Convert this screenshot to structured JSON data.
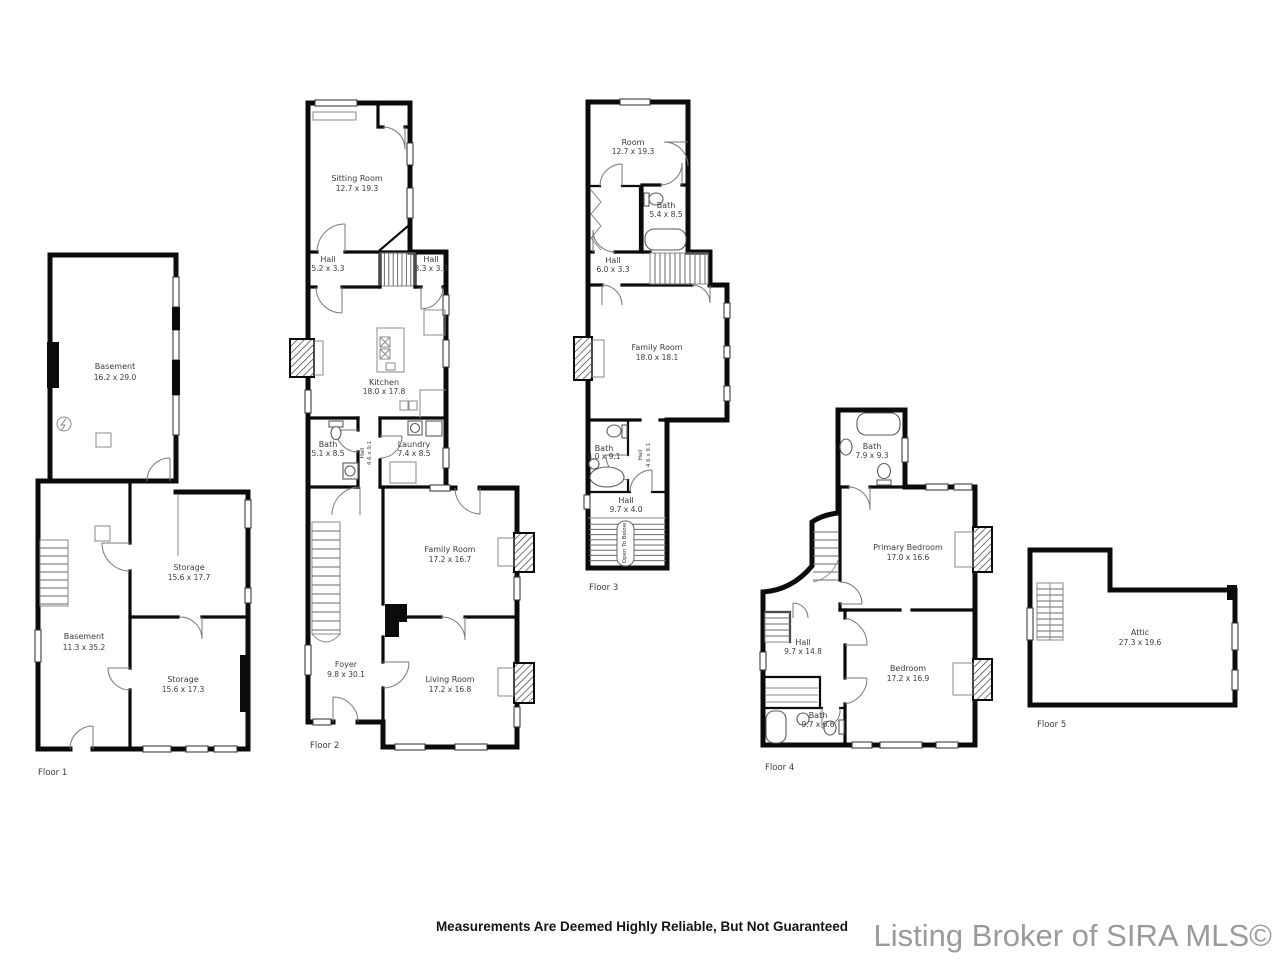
{
  "footer": {
    "disclaimer": "Measurements Are Deemed Highly Reliable, But Not Guaranteed",
    "branding": "Listing Broker of SIRA MLS©"
  },
  "colors": {
    "wall": "#0b0b0b",
    "label": "#3b3b3b",
    "branding": "#9a9a9a"
  },
  "floors": [
    {
      "label": "Floor 1",
      "rooms": [
        {
          "name": "Basement",
          "dims": "16.2 x 29.0"
        },
        {
          "name": "Storage",
          "dims": "15.6 x 17.7"
        },
        {
          "name": "Basement",
          "dims": "11.3 x 35.2"
        },
        {
          "name": "Storage",
          "dims": "15.6 x 17.3"
        }
      ]
    },
    {
      "label": "Floor 2",
      "rooms": [
        {
          "name": "Sitting Room",
          "dims": "12.7 x 19.3"
        },
        {
          "name": "Hall",
          "dims": "5.2 x 3.3"
        },
        {
          "name": "Hall",
          "dims": "3.3 x 3.3"
        },
        {
          "name": "Kitchen",
          "dims": "18.0 x 17.8"
        },
        {
          "name": "Bath",
          "dims": "5.1 x 8.5"
        },
        {
          "name": "Hall",
          "dims": "4.6 x 9.1"
        },
        {
          "name": "Laundry",
          "dims": "7.4 x 8.5"
        },
        {
          "name": "Family Room",
          "dims": "17.2 x 16.7"
        },
        {
          "name": "Foyer",
          "dims": "9.8 x 30.1"
        },
        {
          "name": "Living Room",
          "dims": "17.2 x 16.8"
        }
      ]
    },
    {
      "label": "Floor 3",
      "rooms": [
        {
          "name": "Room",
          "dims": "12.7 x 19.3"
        },
        {
          "name": "Bath",
          "dims": "5.4 x 8.5"
        },
        {
          "name": "Hall",
          "dims": "6.0 x 3.3"
        },
        {
          "name": "Family Room",
          "dims": "18.0 x 18.1"
        },
        {
          "name": "Bath",
          "dims": "4.0 x 9.1"
        },
        {
          "name": "Hall",
          "dims": "4.6 x 9.1"
        },
        {
          "name": "Hall",
          "dims": "9.7 x 4.0"
        }
      ],
      "annotations": {
        "open_to_below": "Open To Below"
      }
    },
    {
      "label": "Floor 4",
      "rooms": [
        {
          "name": "Bath",
          "dims": "7.9 x 9.3"
        },
        {
          "name": "Primary Bedroom",
          "dims": "17.0 x 16.6"
        },
        {
          "name": "Hall",
          "dims": "9.7 x 14.8"
        },
        {
          "name": "Bedroom",
          "dims": "17.2 x 16.9"
        },
        {
          "name": "Bath",
          "dims": "9.7 x 6.6"
        }
      ]
    },
    {
      "label": "Floor 5",
      "rooms": [
        {
          "name": "Attic",
          "dims": "27.3 x 19.6"
        }
      ]
    }
  ]
}
